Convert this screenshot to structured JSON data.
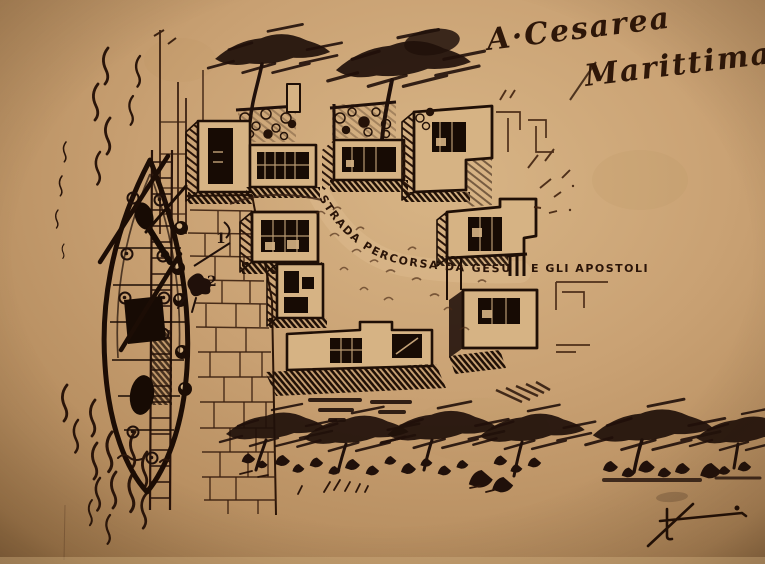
{
  "artwork": {
    "title": {
      "line1": "A·Cesarea",
      "line2": "Marittima"
    },
    "route": {
      "label_arc": "STRADA PERCORSA DA GESÙ",
      "label_end": "E GLI APOSTOLI"
    },
    "markers": {
      "point1": "1",
      "point2": "2"
    },
    "signature": "LF",
    "colors": {
      "paper": "#c9a173",
      "paper_light": "#dcba8c",
      "building_face": "#d6b384",
      "ink": "#1f0f06",
      "ink_soft": "#45281a"
    }
  }
}
